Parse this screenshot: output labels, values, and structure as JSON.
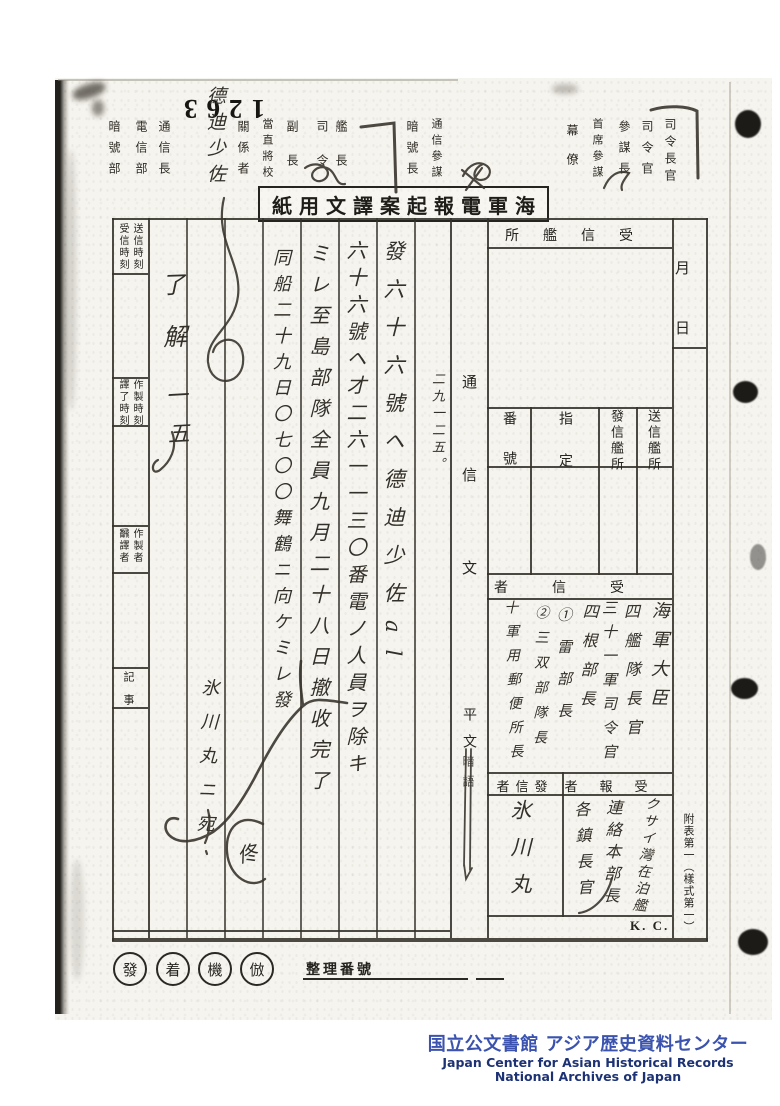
{
  "archive_stamp_number": "1263",
  "routing_labels": [
    "暗號部",
    "電信部",
    "通信長",
    "關係者",
    "當直將校",
    "副長",
    "司令",
    "艦長",
    "暗號長",
    "通信參謀",
    "幕僚",
    "首席參謀",
    "參謀長",
    "司令官",
    "司令長官"
  ],
  "form": {
    "title_rtl": "紙用文譯案起報電軍海",
    "left_col": {
      "send_time": "送信時刻",
      "recv_time": "受信時刻",
      "make_time": "作製時刻",
      "trans_time": "譯了時刻",
      "maker": "作製者",
      "translator": "飜譯者",
      "notes": "記事"
    },
    "center": {
      "comm_text": "通信文",
      "plain": "平文",
      "cipher": "暗語"
    },
    "right": {
      "recv_station_rtl": "所艦信受",
      "number": "番號",
      "assign": "指定",
      "origin_ship": "發信艦所",
      "send_ship": "送信艦所",
      "receiver_rtl": "者信受",
      "receivers": [
        "海軍大臣",
        "四艦隊長官",
        "三十一軍司令官",
        "四根部長",
        "①雷部長",
        "②三双部隊長",
        "十軍用郵便所長"
      ],
      "sender_rtl": "者信發",
      "sender": "氷川丸",
      "report_rtl": "者報受",
      "report_receivers": [
        "クサイ灣在泊艦",
        "連絡本部長",
        "各鎮長官"
      ],
      "kc": "K. C.",
      "month": "月",
      "day": "日",
      "form_ref": "附表第一（樣式第一）"
    },
    "bottom": {
      "stamps": [
        "發",
        "着",
        "機",
        "倣"
      ],
      "serial_label": "整理番號"
    }
  },
  "handwritten": {
    "top_officer": "德迪少佐",
    "msg_time": "二九一二五。",
    "msg_ref": "發六十六號ヘ德迪少佐al",
    "msg_line1": "六十六號ヘ才二六一一三〇番電ノ人員ヲ除キ",
    "msg_line2": "ミレ至島部隊全員九月二十八日撤收完了",
    "msg_line3": "同船二十九日〇七〇〇舞鶴ニ向ケミレ發",
    "ack": "了解",
    "ack_num": "一五",
    "note_hikawa": "氷川丸ニ宛",
    "signature": "佟"
  },
  "footer": {
    "jp": "国立公文書館 アジア歴史資料センター",
    "en1": "Japan Center for Asian Historical Records",
    "en2": "National Archives of Japan",
    "jp_color": "#3b53ae",
    "en_color": "#1d3274"
  }
}
